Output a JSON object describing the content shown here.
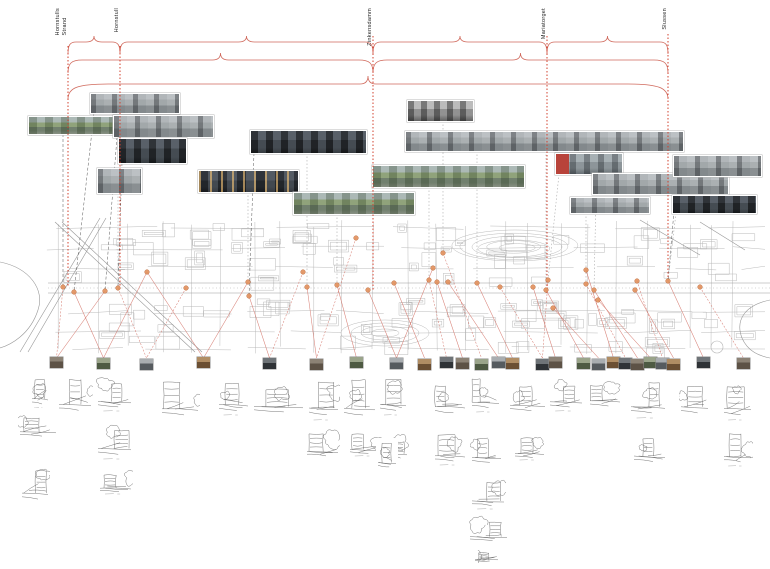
{
  "stations": [
    {
      "label": "Hornstulls Strand",
      "lines": [
        "Hornstulls",
        "Strand"
      ],
      "x": 68
    },
    {
      "label": "Hornstull",
      "lines": [
        "Hornstull"
      ],
      "x": 120
    },
    {
      "label": "Zinkensdamm",
      "lines": [
        "Zinkensdamm"
      ],
      "x": 373
    },
    {
      "label": "Mariatorget",
      "lines": [
        "Mariatorget"
      ],
      "x": 547
    },
    {
      "label": "Slussen",
      "lines": [
        "Slussen"
      ],
      "x": 668
    }
  ],
  "colors": {
    "red_line": "#d2402e",
    "brace": "#d0695c",
    "fan": "#d4756a",
    "dot_fill": "#e2925f",
    "dot_stroke": "#b95f2c",
    "map_line": "#b4b4b4",
    "map_street": "#999999",
    "connector_dark": "#555555",
    "connector_gray": "#aaaaaa",
    "sketch_stroke": "#4d4d4d"
  },
  "braces": {
    "rows": [
      {
        "y": 42,
        "cusp": 6,
        "drop": 12,
        "r": 8,
        "spans": [
          [
            68,
            120
          ],
          [
            120,
            373
          ],
          [
            373,
            547
          ],
          [
            547,
            668
          ]
        ]
      },
      {
        "y": 60,
        "cusp": 7,
        "drop": 13,
        "r": 14,
        "spans": [
          [
            68,
            373
          ],
          [
            373,
            668
          ]
        ]
      },
      {
        "y": 84,
        "cusp": 8,
        "drop": 15,
        "r": 40,
        "spans": [
          [
            68,
            668
          ]
        ]
      }
    ]
  },
  "verticals": [
    {
      "x": 68,
      "y1": 46,
      "y2": 287
    },
    {
      "x": 120,
      "y1": 46,
      "y2": 291
    },
    {
      "x": 373,
      "y1": 36,
      "y2": 290
    },
    {
      "x": 547,
      "y1": 36,
      "y2": 295
    },
    {
      "x": 668,
      "y1": 34,
      "y2": 281
    }
  ],
  "photos": [
    {
      "x": 90,
      "y": 93,
      "w": 88,
      "h": 19,
      "palette": "overcast"
    },
    {
      "x": 28,
      "y": 116,
      "w": 93,
      "h": 17,
      "palette": "sunny"
    },
    {
      "x": 113,
      "y": 115,
      "w": 99,
      "h": 21,
      "palette": "overcast"
    },
    {
      "x": 118,
      "y": 138,
      "w": 67,
      "h": 24,
      "palette": "dark"
    },
    {
      "x": 250,
      "y": 130,
      "w": 115,
      "h": 22,
      "palette": "dark"
    },
    {
      "x": 97,
      "y": 168,
      "w": 43,
      "h": 24,
      "palette": "overcast"
    },
    {
      "x": 198,
      "y": 170,
      "w": 99,
      "h": 21,
      "palette": "dusk"
    },
    {
      "x": 293,
      "y": 192,
      "w": 120,
      "h": 21,
      "palette": "sunny"
    },
    {
      "x": 372,
      "y": 165,
      "w": 151,
      "h": 21,
      "palette": "sunny"
    },
    {
      "x": 405,
      "y": 131,
      "w": 277,
      "h": 19,
      "palette": "overcast"
    },
    {
      "x": 407,
      "y": 100,
      "w": 65,
      "h": 20,
      "palette": "bw"
    },
    {
      "x": 555,
      "y": 153,
      "w": 66,
      "h": 20,
      "palette": "bus"
    },
    {
      "x": 592,
      "y": 173,
      "w": 135,
      "h": 20,
      "palette": "overcast"
    },
    {
      "x": 673,
      "y": 155,
      "w": 87,
      "h": 20,
      "palette": "overcast"
    },
    {
      "x": 570,
      "y": 197,
      "w": 78,
      "h": 15,
      "palette": "overcast"
    },
    {
      "x": 672,
      "y": 195,
      "w": 83,
      "h": 17,
      "palette": "dark"
    }
  ],
  "dots": [
    [
      63,
      287
    ],
    [
      74,
      292
    ],
    [
      105,
      291
    ],
    [
      118,
      288
    ],
    [
      147,
      272
    ],
    [
      186,
      288
    ],
    [
      248,
      282
    ],
    [
      249,
      296
    ],
    [
      303,
      272
    ],
    [
      307,
      287
    ],
    [
      337,
      285
    ],
    [
      356,
      238
    ],
    [
      368,
      290
    ],
    [
      394,
      283
    ],
    [
      429,
      280
    ],
    [
      433,
      268
    ],
    [
      437,
      282
    ],
    [
      443,
      253
    ],
    [
      448,
      282
    ],
    [
      477,
      283
    ],
    [
      500,
      287
    ],
    [
      533,
      287
    ],
    [
      546,
      290
    ],
    [
      548,
      280
    ],
    [
      553,
      308
    ],
    [
      586,
      270
    ],
    [
      586,
      284
    ],
    [
      594,
      290
    ],
    [
      598,
      300
    ],
    [
      637,
      281
    ],
    [
      635,
      290
    ],
    [
      668,
      281
    ],
    [
      700,
      287
    ]
  ],
  "thumbnails": {
    "y": 357,
    "w": 13,
    "h": 11,
    "xs": [
      50,
      97,
      140,
      197,
      263,
      310,
      350,
      390,
      418,
      440,
      456,
      475,
      492,
      506,
      536,
      549,
      577,
      592,
      607,
      619,
      631,
      644,
      656,
      667,
      697,
      737
    ]
  },
  "sketches": [
    [
      30,
      370,
      20,
      40
    ],
    [
      57,
      372,
      36,
      45
    ],
    [
      96,
      372,
      37,
      41
    ],
    [
      160,
      375,
      40,
      47
    ],
    [
      217,
      373,
      33,
      44
    ],
    [
      252,
      377,
      53,
      41
    ],
    [
      307,
      372,
      33,
      50
    ],
    [
      342,
      370,
      35,
      53
    ],
    [
      378,
      372,
      30,
      45
    ],
    [
      433,
      372,
      34,
      48
    ],
    [
      470,
      372,
      31,
      42
    ],
    [
      508,
      375,
      39,
      42
    ],
    [
      548,
      373,
      36,
      40
    ],
    [
      588,
      372,
      34,
      40
    ],
    [
      629,
      373,
      38,
      47
    ],
    [
      679,
      373,
      31,
      47
    ],
    [
      722,
      373,
      31,
      49
    ],
    [
      18,
      408,
      40,
      33
    ],
    [
      96,
      416,
      37,
      45
    ],
    [
      20,
      460,
      30,
      46
    ],
    [
      98,
      468,
      35,
      28
    ],
    [
      305,
      427,
      35,
      34
    ],
    [
      348,
      427,
      34,
      31
    ],
    [
      388,
      430,
      21,
      33
    ],
    [
      433,
      427,
      34,
      40
    ],
    [
      470,
      430,
      33,
      38
    ],
    [
      513,
      432,
      33,
      30
    ],
    [
      632,
      425,
      35,
      43
    ],
    [
      722,
      427,
      31,
      41
    ],
    [
      376,
      438,
      22,
      34
    ],
    [
      470,
      475,
      36,
      36
    ],
    [
      468,
      515,
      41,
      30
    ],
    [
      473,
      550,
      27,
      13
    ]
  ],
  "connections": {
    "fan": [
      [
        0,
        0
      ],
      [
        1,
        1
      ],
      [
        2,
        0
      ],
      [
        3,
        2
      ],
      [
        4,
        1
      ],
      [
        4,
        3
      ],
      [
        5,
        2
      ],
      [
        6,
        3
      ],
      [
        7,
        4
      ],
      [
        8,
        4
      ],
      [
        9,
        5
      ],
      [
        10,
        6
      ],
      [
        11,
        5
      ],
      [
        12,
        7
      ],
      [
        13,
        8
      ],
      [
        14,
        9
      ],
      [
        15,
        7
      ],
      [
        16,
        10
      ],
      [
        17,
        11
      ],
      [
        18,
        12
      ],
      [
        19,
        13
      ],
      [
        20,
        14
      ],
      [
        21,
        15
      ],
      [
        22,
        16
      ],
      [
        23,
        14
      ],
      [
        24,
        17
      ],
      [
        25,
        18
      ],
      [
        26,
        19
      ],
      [
        27,
        20
      ],
      [
        28,
        21
      ],
      [
        29,
        22
      ],
      [
        30,
        23
      ],
      [
        31,
        24
      ],
      [
        32,
        25
      ]
    ],
    "photo_links": [
      [
        0,
        1,
        "dark"
      ],
      [
        1,
        0,
        "dark"
      ],
      [
        2,
        2,
        "dark"
      ],
      [
        3,
        3,
        "dark"
      ],
      [
        4,
        9,
        "gray"
      ],
      [
        4,
        7,
        "dark"
      ],
      [
        5,
        3,
        "gray"
      ],
      [
        6,
        6,
        "gray"
      ],
      [
        7,
        10,
        "gray"
      ],
      [
        8,
        14,
        "gray"
      ],
      [
        9,
        22,
        "gray"
      ],
      [
        9,
        19,
        "gray"
      ],
      [
        10,
        17,
        "gray"
      ],
      [
        11,
        23,
        "gray"
      ],
      [
        12,
        27,
        "gray"
      ],
      [
        13,
        31,
        "dark"
      ],
      [
        14,
        26,
        "gray"
      ],
      [
        15,
        31,
        "gray"
      ]
    ]
  },
  "map": {
    "x": 0,
    "y": 218,
    "w": 770,
    "h": 140,
    "street_y": 288
  }
}
